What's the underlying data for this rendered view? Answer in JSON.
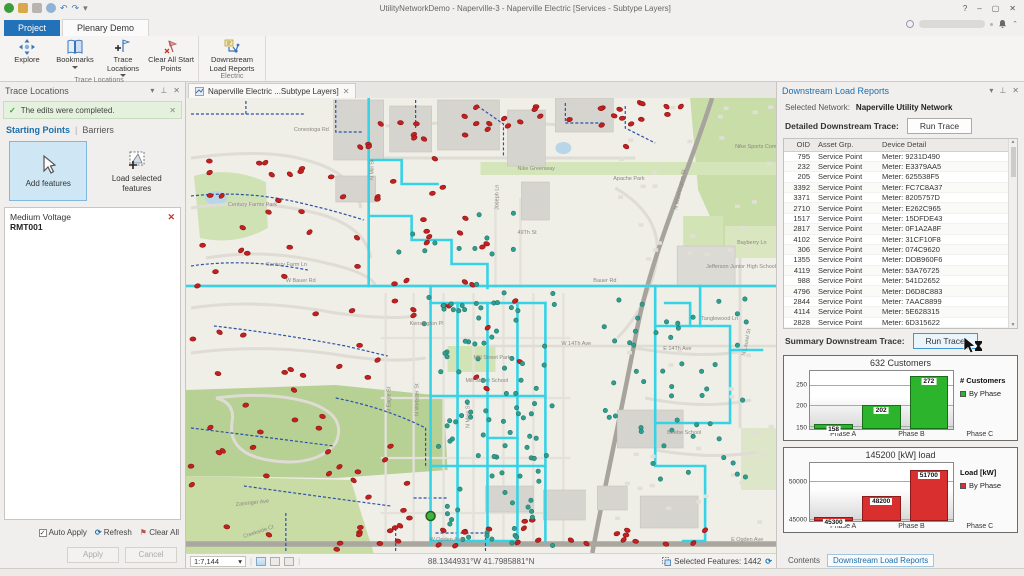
{
  "titlebar": {
    "title": "UtilityNetworkDemo - Naperville-3 - Naperville Electric [Services - Subtype Layers]",
    "controls": {
      "help": "?",
      "minimize": "–",
      "maximize": "▢",
      "close": "✕"
    }
  },
  "ribbon": {
    "tabs": [
      {
        "label": "Project"
      },
      {
        "label": "Plenary Demo"
      }
    ],
    "groups": [
      {
        "label": "Trace Locations",
        "buttons": [
          "Explore",
          "Bookmarks",
          "Trace Locations",
          "Clear All Start Points"
        ]
      },
      {
        "label": "Electric",
        "buttons": [
          "Downstream Load Reports"
        ]
      }
    ]
  },
  "trace_panel": {
    "title": "Trace Locations",
    "message": "The edits were completed.",
    "message_close": "✕",
    "tab_starting": "Starting Points",
    "tab_sep": "|",
    "tab_barriers": "Barriers",
    "add_features": "Add features",
    "load_selected": "Load selected features",
    "item_type": "Medium Voltage",
    "item_name": "RMT001",
    "item_remove": "✕",
    "auto_apply": "Auto Apply",
    "refresh": "Refresh",
    "clear_all": "Clear All",
    "apply": "Apply",
    "cancel": "Cancel"
  },
  "map": {
    "tab": "Naperville Electric ...Subtype Layers]",
    "tab_close": "✕",
    "scale": "1:7,144",
    "coordinates": "88.1344931°W 41.7985881°N",
    "selected_features": "Selected Features: 1442",
    "labels": [
      {
        "t": "Conestoga Rd",
        "x": 108,
        "y": 33
      },
      {
        "t": "Century Farms Park",
        "x": 42,
        "y": 108
      },
      {
        "t": "Century Farm Ln",
        "x": 80,
        "y": 168
      },
      {
        "t": "W Bauer Rd",
        "x": 100,
        "y": 184
      },
      {
        "t": "Bauer Rd",
        "x": 408,
        "y": 184
      },
      {
        "t": "N Mill St",
        "x": 188,
        "y": 82,
        "r": -90
      },
      {
        "t": "Nike Sports Complex",
        "x": 550,
        "y": 50
      },
      {
        "t": "Nike Greenway",
        "x": 332,
        "y": 72
      },
      {
        "t": "Apache Park",
        "x": 428,
        "y": 82
      },
      {
        "t": "49Th St",
        "x": 332,
        "y": 136
      },
      {
        "t": "Joseph Ln",
        "x": 313,
        "y": 112,
        "r": -90
      },
      {
        "t": "N Washington St",
        "x": 492,
        "y": 112,
        "r": -78
      },
      {
        "t": "Bayberry Ln",
        "x": 552,
        "y": 146
      },
      {
        "t": "Jefferson Junior High School",
        "x": 521,
        "y": 170
      },
      {
        "t": "Tanglewood Ln",
        "x": 516,
        "y": 222
      },
      {
        "t": "Kensington Pl",
        "x": 224,
        "y": 227
      },
      {
        "t": "W 14Th Ave",
        "x": 376,
        "y": 247
      },
      {
        "t": "E 14Th Ave",
        "x": 478,
        "y": 252
      },
      {
        "t": "Mill Street Park",
        "x": 288,
        "y": 261
      },
      {
        "t": "Mill Street School",
        "x": 280,
        "y": 284
      },
      {
        "t": "N Eagle St",
        "x": 205,
        "y": 315,
        "r": -90
      },
      {
        "t": "N Webster St",
        "x": 233,
        "y": 318,
        "r": -90
      },
      {
        "t": "N Main St",
        "x": 284,
        "y": 330,
        "r": -90
      },
      {
        "t": "N Laurel St",
        "x": 560,
        "y": 258,
        "r": -78
      },
      {
        "t": "Beebe School",
        "x": 482,
        "y": 336
      },
      {
        "t": "Zaininger Ave",
        "x": 50,
        "y": 408,
        "r": -6
      },
      {
        "t": "Creekside Ct",
        "x": 58,
        "y": 440,
        "r": -18
      },
      {
        "t": "W Ogden Ave",
        "x": 244,
        "y": 443
      },
      {
        "t": "E Ogden Ave",
        "x": 546,
        "y": 443
      }
    ]
  },
  "report_panel": {
    "title": "Downstream Load Reports",
    "selected_network_label": "Selected Network:",
    "selected_network": "Naperville Utility Network",
    "detailed_label": "Detailed Downstream Trace:",
    "run_trace": "Run Trace",
    "summary_label": "Summary Downstream Trace:",
    "table": {
      "columns": [
        "OID",
        "Asset Grp.",
        "Device Detail"
      ],
      "rows": [
        [
          "795",
          "Service Point",
          "Meter: 9231D490"
        ],
        [
          "232",
          "Service Point",
          "Meter: E3379AA5"
        ],
        [
          "205",
          "Service Point",
          "Meter: 625538F5"
        ],
        [
          "3392",
          "Service Point",
          "Meter: FC7C8A37"
        ],
        [
          "3371",
          "Service Point",
          "Meter: 8205757D"
        ],
        [
          "2710",
          "Service Point",
          "Meter: E262C965"
        ],
        [
          "1517",
          "Service Point",
          "Meter: 15DFDE43"
        ],
        [
          "2817",
          "Service Point",
          "Meter: 0F1A2A8F"
        ],
        [
          "4102",
          "Service Point",
          "Meter: 31CF10F8"
        ],
        [
          "306",
          "Service Point",
          "Meter: 074C9620"
        ],
        [
          "1355",
          "Service Point",
          "Meter: DDB960F6"
        ],
        [
          "4119",
          "Service Point",
          "Meter: 53A76725"
        ],
        [
          "988",
          "Service Point",
          "Meter: 541D2652"
        ],
        [
          "4796",
          "Service Point",
          "Meter: D6D8C883"
        ],
        [
          "2844",
          "Service Point",
          "Meter: 7AAC8899"
        ],
        [
          "4114",
          "Service Point",
          "Meter: 5E628315"
        ],
        [
          "2828",
          "Service Point",
          "Meter: 6D315622"
        ]
      ]
    },
    "bottom_tabs": [
      "Contents",
      "Downstream Load Reports"
    ]
  },
  "chart_data": [
    {
      "type": "bar",
      "title": "632 Customers",
      "categories": [
        "Phase A",
        "Phase B",
        "Phase C"
      ],
      "values": [
        158,
        202,
        272
      ],
      "yticks": [
        150,
        200,
        250
      ],
      "ylim": [
        145,
        285
      ],
      "legend_title": "# Customers",
      "legend_entry": "By Phase",
      "color": "#2cb52c",
      "border": "#176e17"
    },
    {
      "type": "bar",
      "title": "145200 [kW] load",
      "categories": [
        "Phase A",
        "Phase B",
        "Phase C"
      ],
      "values": [
        45300,
        48200,
        51700
      ],
      "yticks": [
        45000,
        50000
      ],
      "ylim": [
        44800,
        52600
      ],
      "legend_title": "Load [kW]",
      "legend_entry": "By Phase",
      "color": "#d92f2f",
      "border": "#8e1b1b"
    }
  ]
}
